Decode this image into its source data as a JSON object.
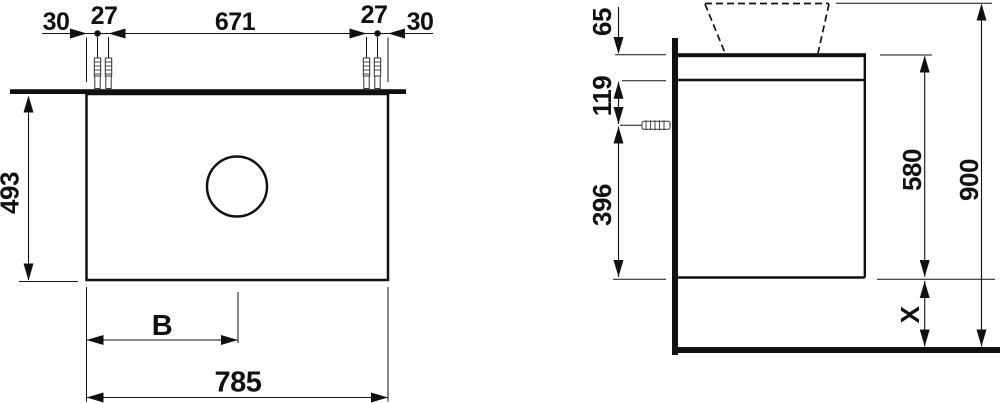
{
  "colors": {
    "ink": "#111111",
    "background": "#ffffff"
  },
  "front_view": {
    "edge_to_screw_left": "30",
    "screw_pair_gap_left": "27",
    "screw_span": "671",
    "screw_pair_gap_right": "27",
    "edge_to_screw_right": "30",
    "body_height": "493",
    "hole_center_offset": "B",
    "body_width": "785"
  },
  "side_view": {
    "countertop_section_height": "65",
    "top_to_screw": "119",
    "screw_to_bottom": "396",
    "carcass_height": "580",
    "total_height": "900",
    "floor_clearance": "X"
  }
}
